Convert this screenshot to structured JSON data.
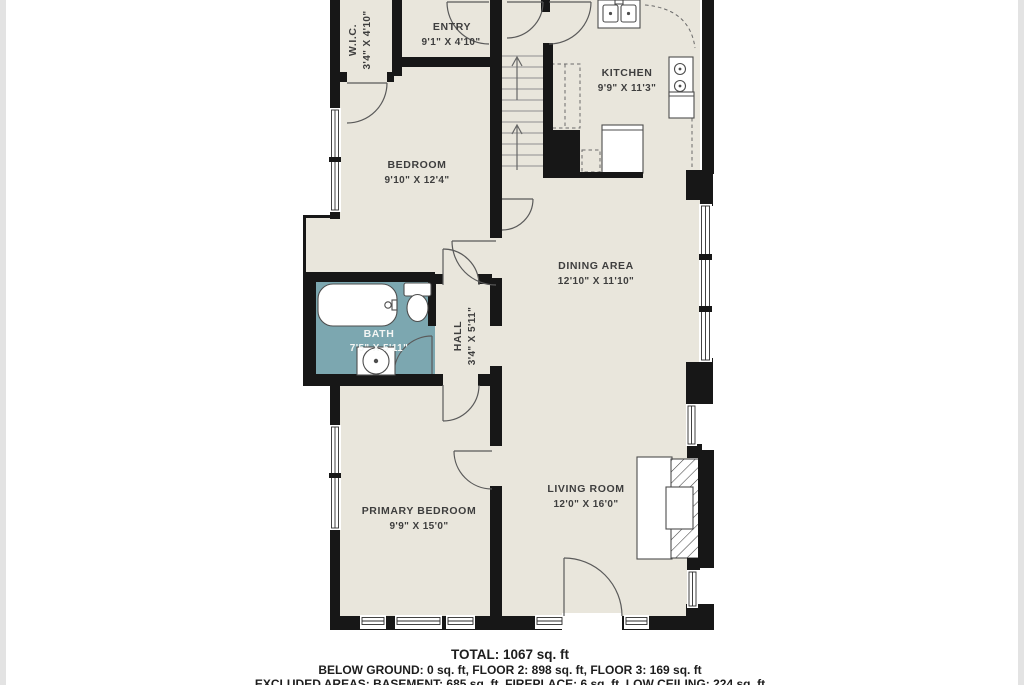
{
  "plan": {
    "rooms": [
      {
        "id": "wic",
        "name": "W.I.C.",
        "dims": "3'4\" X 4'10\""
      },
      {
        "id": "entry",
        "name": "ENTRY",
        "dims": "9'1\" X 4'10\""
      },
      {
        "id": "kitchen",
        "name": "KITCHEN",
        "dims": "9'9\" X 11'3\""
      },
      {
        "id": "bedroom",
        "name": "BEDROOM",
        "dims": "9'10\" X 12'4\""
      },
      {
        "id": "dining_area",
        "name": "DINING AREA",
        "dims": "12'10\" X 11'10\""
      },
      {
        "id": "bath",
        "name": "BATH",
        "dims": "7'5\" X 5'11\""
      },
      {
        "id": "hall",
        "name": "HALL",
        "dims": "3'4\" X 5'11\""
      },
      {
        "id": "primary_bedroom",
        "name": "PRIMARY BEDROOM",
        "dims": "9'9\" X 15'0\""
      },
      {
        "id": "living_room",
        "name": "LIVING ROOM",
        "dims": "12'0\" X 16'0\""
      }
    ],
    "fixtures": [
      "kitchen-sink",
      "stove",
      "refrigerator",
      "stairs-up",
      "bathtub",
      "toilet",
      "vanity-sink",
      "fireplace"
    ],
    "colors": {
      "floor": "#e9e6dc",
      "bath_floor": "#7ca7b0",
      "wall": "#171717",
      "label": "#3e3e3e",
      "bath_label": "#f4f6f4",
      "fixture_line": "#4d4d4d",
      "background": "#ffffff"
    }
  },
  "footer": {
    "total": "TOTAL: 1067 sq. ft",
    "floors": "BELOW GROUND: 0 sq. ft, FLOOR 2: 898 sq. ft, FLOOR 3: 169 sq. ft",
    "excluded": "EXCLUDED AREAS: BASEMENT: 685 sq. ft, FIREPLACE: 6 sq. ft, LOW CEILING: 224 sq. ft"
  }
}
